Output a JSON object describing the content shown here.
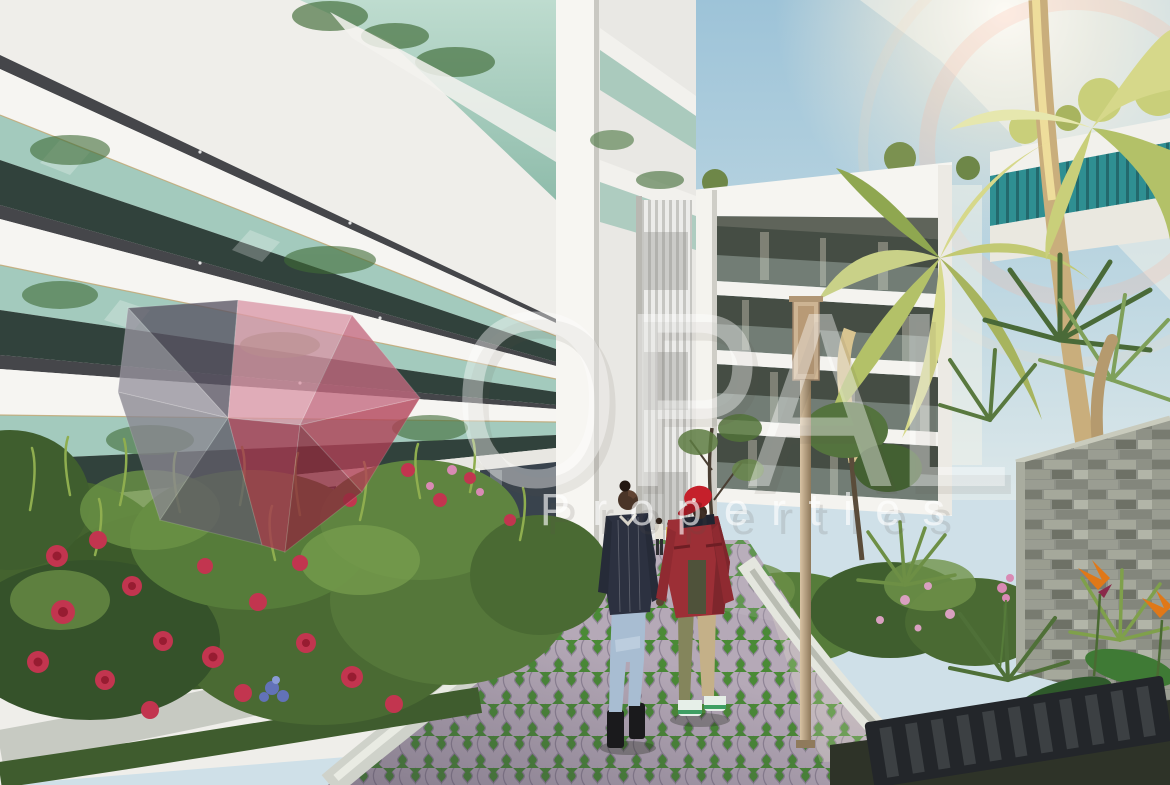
{
  "meta": {
    "type": "architectural-rendering",
    "width_px": 1170,
    "height_px": 785
  },
  "watermark": {
    "brand_name": "OPAL",
    "brand_subtitle": "Properties",
    "logo_name": "opal-gem-logo",
    "text_color": "#ffffff",
    "gem_colors": {
      "slate": "#5a5564",
      "pink_top": "#db98a8",
      "rose": "#c4697f",
      "gray_left": "#97939e",
      "gray_mid": "#8a8791",
      "gray_dark": "#615d69",
      "crimson": "#a63850",
      "red_dark": "#8e2b3d",
      "red": "#b24056"
    }
  },
  "scene": {
    "description": "Courtyard rendering of a modern white apartment complex: two men walk on a grass-paver path between rose beds, tropical palms and a stacked-stone wall under a sunlit sky",
    "sky": {
      "top": "#9dc3d8",
      "horizon": "#d6e5ea",
      "sun_glow": "#fff6e6"
    },
    "left_building": {
      "facade": "#efeeea",
      "fascia": "#f6f5f2",
      "soffit": "#45464a",
      "glass": "#a3cabd",
      "window": "#31423c",
      "ground_glass": "#39434d",
      "fence": "#232e46",
      "trim": "#c2a671"
    },
    "center_building": {
      "slab": "#f6f5f1",
      "window_band": "#454d44",
      "louver_light": "#ececea",
      "louver_dark": "#c6c6c2",
      "mullion": "#f4f3ee"
    },
    "right_building": {
      "glass_teal": "#2f8f92",
      "fascia": "#f2f1ec"
    },
    "stone_wall": {
      "base": "#8e9188",
      "light": "#b2b5a8",
      "dark": "#6e7166"
    },
    "walkway": {
      "paver": "#b5a9b7",
      "grass_joint": "#4a8a36",
      "curb": "#cfd2ca"
    },
    "garden": {
      "foliage_dark": "#3c5a30",
      "foliage_mid": "#567c3a",
      "foliage_light": "#7fa04b",
      "rose_red": "#c2354f",
      "rose_core": "#971c31",
      "flower_pink": "#d98ab4",
      "flower_blue": "#6272b8",
      "bird_of_paradise": "#e07818"
    },
    "palms": {
      "sunlit": "#d6d88a",
      "pale": "#e6e7ae",
      "mid": "#b3c168",
      "shaded": "#8fa750",
      "dark": "#4a6a38",
      "trunk": "#c9ae7c"
    },
    "people": [
      {
        "id": "man-left",
        "jacket": "#2c3140",
        "jeans": "#a8bdd2",
        "boots": "#1a1a1c",
        "skin": "#4a3528"
      },
      {
        "id": "man-right",
        "cap": "#c5202b",
        "jacket": "#9c2f36",
        "shirt": "#4f523a",
        "trouser_left": "#84855c",
        "trouser_right": "#c4b088",
        "shoes": "#e6efe8"
      }
    ],
    "lamp_post": {
      "color": "#cdb493"
    },
    "drain_grate": {
      "color": "#23262a"
    }
  }
}
